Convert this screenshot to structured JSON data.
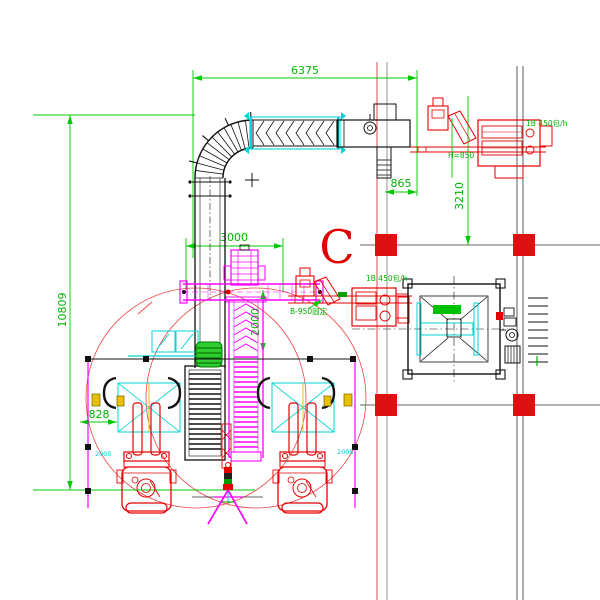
{
  "drawing": {
    "type": "CAD plan view – bagging and palletizing line layout",
    "dimensions": {
      "top_width": "6375",
      "left_height": "10809",
      "conveyor_span": "3000",
      "drop_span": "2000",
      "machine_offset": "865",
      "bay_span": "3210",
      "pallet_offset": "828"
    },
    "labels": {
      "section_mark": "C",
      "height_note": "H=850",
      "fixed_note": "B-950固定",
      "rate_note_mid": "1B 450包/h",
      "rate_note_top": "1B 450包/h",
      "pallet_code_left": "2005",
      "pallet_code_right": "2005"
    },
    "colors": {
      "dimension_green": "#00c800",
      "conveyor_magenta": "#ff00ff",
      "highlight_cyan": "#00d5d5",
      "equipment_red": "#e60000",
      "column_red": "#dd1111",
      "line_black": "#111111",
      "fixture_yellow": "#e8c000"
    }
  }
}
